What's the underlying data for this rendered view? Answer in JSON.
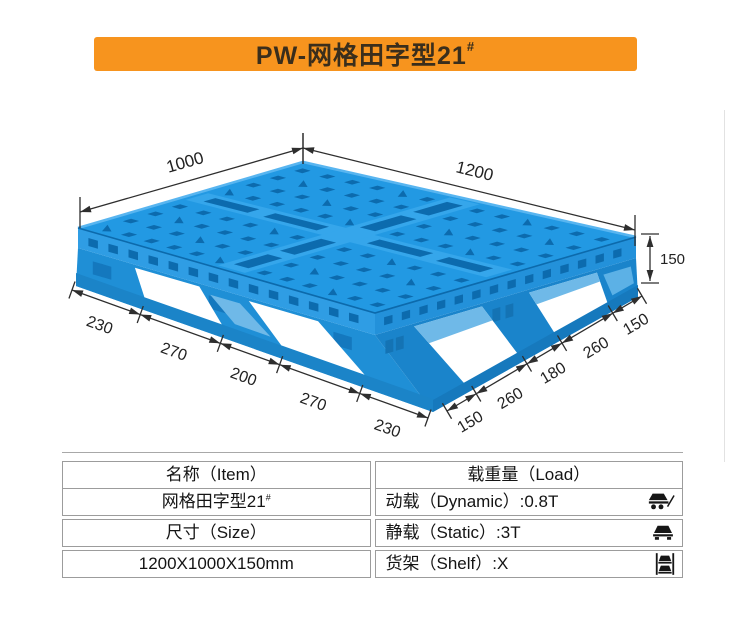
{
  "banner": {
    "title_main": "PW-网格田字型21",
    "title_sup": "#",
    "bg_color": "#F7941E",
    "text_color": "#3A2E1C"
  },
  "figure": {
    "dims": {
      "top_left": "1000",
      "top_right": "1200",
      "height": "150",
      "front_left_segments": [
        "230",
        "270",
        "200",
        "270",
        "230"
      ],
      "front_right_segments": [
        "150",
        "260",
        "180",
        "260",
        "150"
      ]
    },
    "colors": {
      "top_face": "#2299E3",
      "top_band": "#35A6EB",
      "hole": "#0C6BAE",
      "deck_side_left": "#2F9DE4",
      "deck_side_right": "#2391DA",
      "skirt_left": "#1F8FD6",
      "skirt_right": "#1A84CB",
      "rail_left": "#1B84C8",
      "rail_right": "#1679BD",
      "window": "#FFFFFF",
      "pocket": "#6FB9E8",
      "rim_light": "#58B5F0",
      "rim_dark": "#0C6AAC",
      "ink": "#2E2E2E",
      "label": "#222222"
    }
  },
  "table": {
    "left": [
      {
        "text": "名称（Item）",
        "sup": ""
      },
      {
        "text": "网格田字型21",
        "sup": "#"
      },
      {
        "text": "尺寸（Size）",
        "sup": ""
      },
      {
        "text": "1200X1000X150mm",
        "sup": ""
      }
    ],
    "right_header": "载重量（Load）",
    "right_rows": [
      {
        "text": "动载（Dynamic）:0.8T",
        "icon": "dynamic-load-icon"
      },
      {
        "text": "静载（Static）:3T",
        "icon": "static-load-icon"
      },
      {
        "text": "货架（Shelf）:X",
        "icon": "shelf-load-icon"
      }
    ],
    "border_color": "#9C9C9C"
  }
}
